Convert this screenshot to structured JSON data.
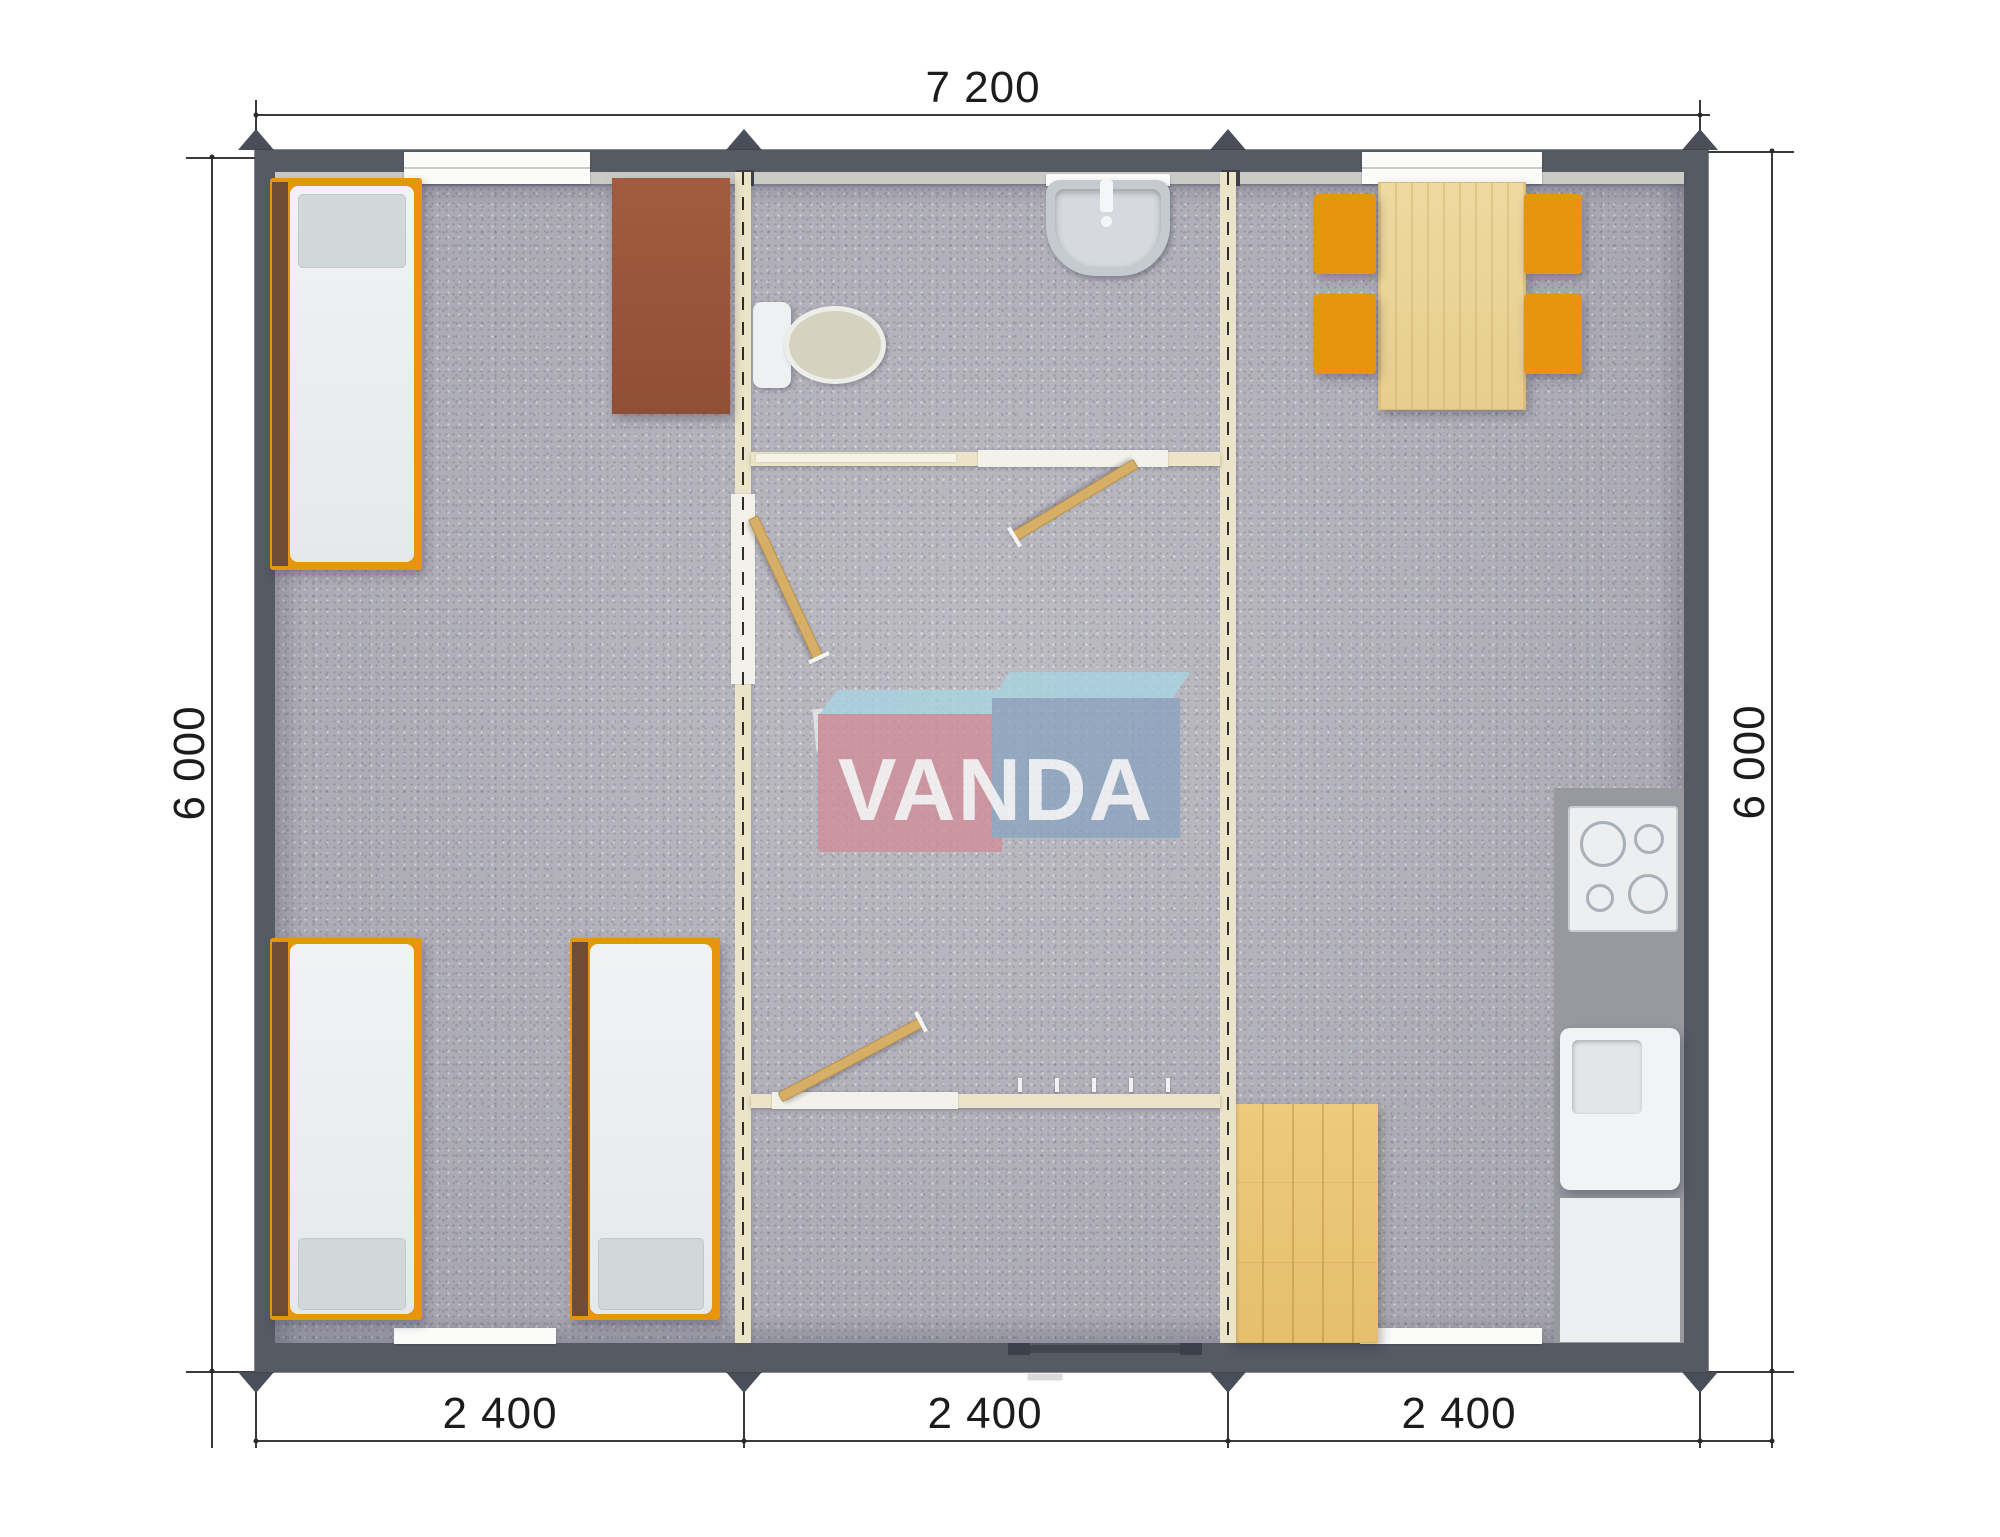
{
  "logo": {
    "text": "VANDA"
  },
  "dimensions": {
    "top": "7 200",
    "left": "6 000",
    "right": "6 000",
    "bottom": [
      "2 400",
      "2 400",
      "2 400"
    ]
  },
  "colors": {
    "wall": "#565a63",
    "floor": "#b6b5bd",
    "liner": "#c9cbc4",
    "partition": "#ece4c8",
    "orange": "#e8950e",
    "pillow": "#d2d7da",
    "counter": "#97999e",
    "door_wood": "#d7ae65",
    "desk_brown": "#9e583c",
    "wood_light": "#ecd290",
    "wood_floor": "#e9c878",
    "logo_pink": "#d18e99",
    "logo_blue": "#8ba4c0",
    "logo_sky": "#a9d4e3"
  },
  "building": {
    "modules": [
      "bedroom-module",
      "sanitary-hall-module",
      "kitchen-dining-module"
    ]
  },
  "furniture": {
    "bedroom": [
      "single-bed",
      "single-bed",
      "single-bed",
      "wardrobe"
    ],
    "sanitary": [
      "toilet",
      "washbasin"
    ],
    "hall": [
      "entrance-door",
      "coat-hooks"
    ],
    "kitchen": [
      "dining-table",
      "stool",
      "stool",
      "stool",
      "stool",
      "cooktop",
      "kitchen-sink",
      "kitchen-cabinet",
      "wood-deck"
    ]
  }
}
